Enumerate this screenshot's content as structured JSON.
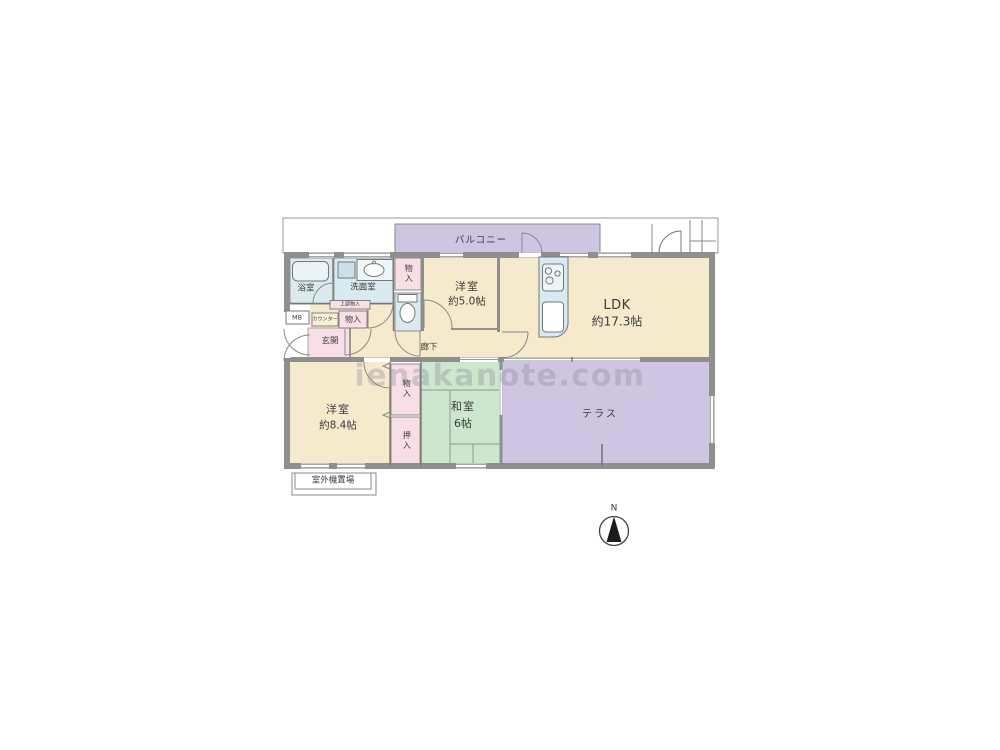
{
  "watermark": "ienakanote.com",
  "compass_label": "N",
  "labels": {
    "balcony": "バルコニー",
    "bath": "浴室",
    "washroom": "洗面室",
    "closet_top": "物入",
    "western_room_small_name": "洋室",
    "western_room_small_size": "約5.0帖",
    "ldk_name": "LDK",
    "ldk_size": "約17.3帖",
    "meter_box": "MB",
    "upper_closet": "上部物入",
    "counter": "カウンター",
    "entry_closet": "物入",
    "entrance": "玄関",
    "hallway": "廊下",
    "western_room_large_name": "洋室",
    "western_room_large_size": "約8.4帖",
    "closet_lower": "物入",
    "oshiire": "押入",
    "japanese_room_name": "和室",
    "japanese_room_size": "6帖",
    "terrace": "テラス",
    "outdoor_unit": "室外機置場"
  },
  "colors": {
    "room_beige": "#F6EACC",
    "water_blue": "#D9EAF1",
    "closet_pink": "#F9DEE5",
    "tatami_green": "#CDE7CE",
    "outdoor_purple": "#CDC5E1",
    "wall_gray": "#8F8F8F",
    "counter_yellow": "#F6F0D6"
  }
}
